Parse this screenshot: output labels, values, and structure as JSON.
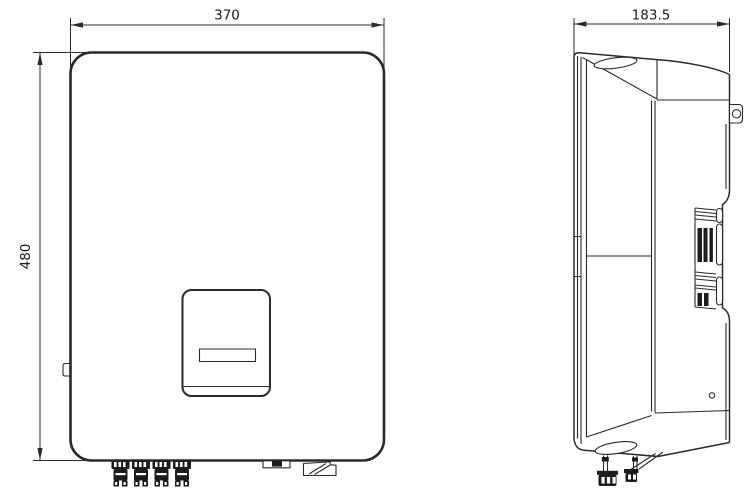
{
  "drawing": {
    "background_color": "#ffffff",
    "line_color": "#2a2a2a",
    "front_view": {
      "width_label": "370",
      "height_label": "480"
    },
    "side_view": {
      "depth_label": "183.5"
    }
  }
}
